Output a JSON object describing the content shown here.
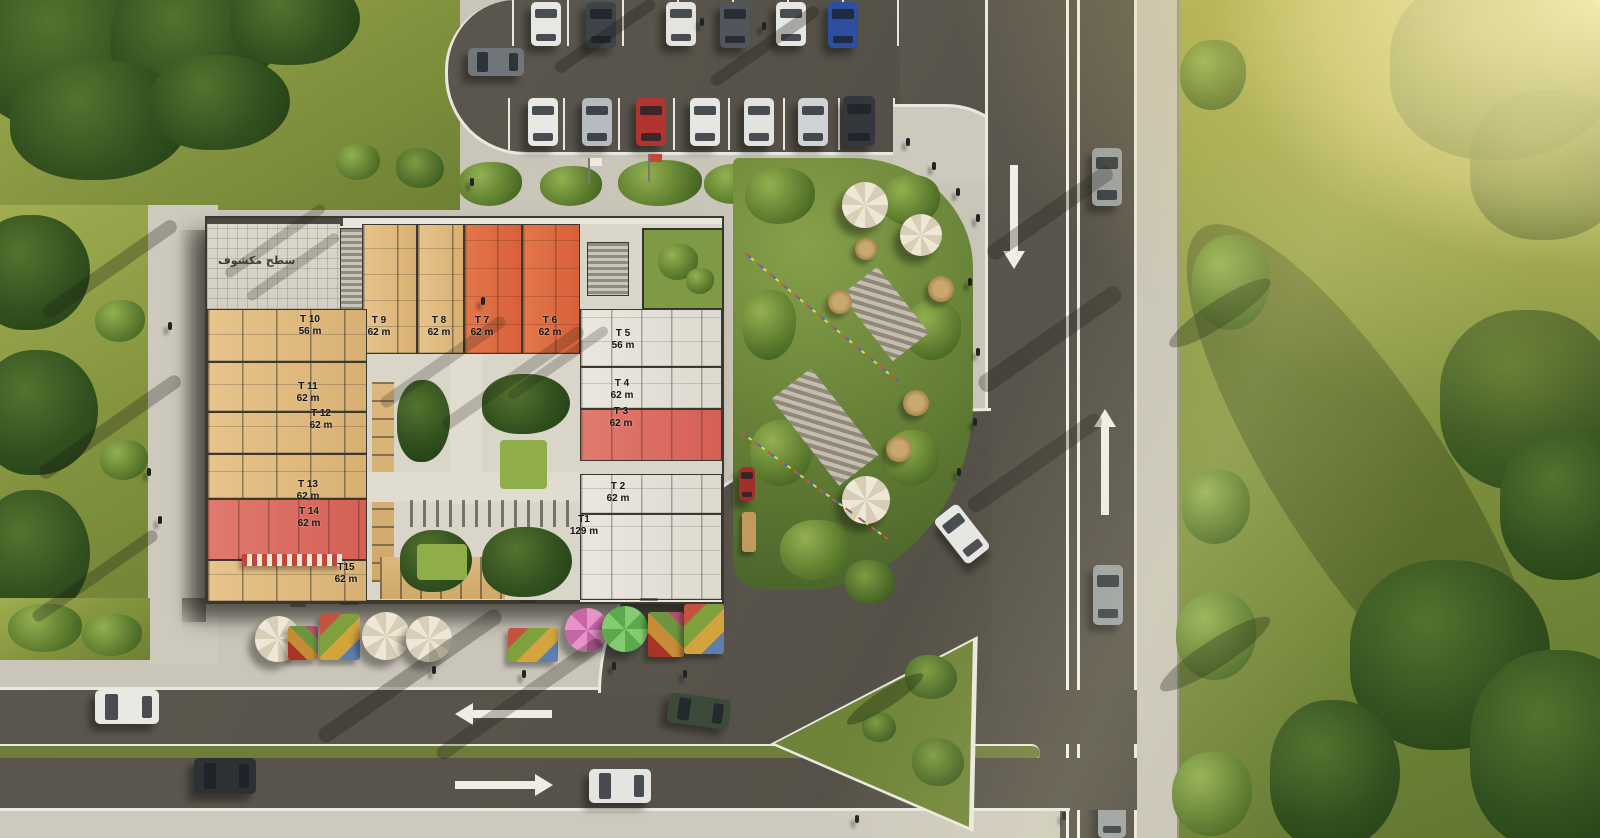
{
  "scene": {
    "type": "aerial site plan render",
    "roof_terrace_label": "سطح مكشوف",
    "units": [
      {
        "id": "T1",
        "area": "129 m",
        "fill": "white"
      },
      {
        "id": "T 2",
        "area": "62 m",
        "fill": "white"
      },
      {
        "id": "T 3",
        "area": "62 m",
        "fill": "red-highlight"
      },
      {
        "id": "T 4",
        "area": "62 m",
        "fill": "white"
      },
      {
        "id": "T 5",
        "area": "56 m",
        "fill": "white"
      },
      {
        "id": "T 6",
        "area": "62 m",
        "fill": "orange-highlight"
      },
      {
        "id": "T 7",
        "area": "62 m",
        "fill": "orange-highlight"
      },
      {
        "id": "T 8",
        "area": "62 m",
        "fill": "tan"
      },
      {
        "id": "T 9",
        "area": "62 m",
        "fill": "tan"
      },
      {
        "id": "T 10",
        "area": "56 m",
        "fill": "tan"
      },
      {
        "id": "T 11",
        "area": "62 m",
        "fill": "tan"
      },
      {
        "id": "T 12",
        "area": "62 m",
        "fill": "tan"
      },
      {
        "id": "T 13",
        "area": "62 m",
        "fill": "tan"
      },
      {
        "id": "T 14",
        "area": "62 m",
        "fill": "red-highlight"
      },
      {
        "id": "T15",
        "area": "62 m",
        "fill": "tan"
      }
    ],
    "highlight_colors": {
      "red": "#dc6a60",
      "orange": "#dd6f41",
      "tan": "#e2bd85",
      "white": "#e6e4dd",
      "asphalt": "#57534a",
      "grass": "#84933f"
    },
    "traffic_arrows": [
      {
        "id": "bottom-road-upper-lane",
        "direction": "left"
      },
      {
        "id": "bottom-road-lower-lane",
        "direction": "right"
      },
      {
        "id": "right-road-west-lane",
        "direction": "down"
      },
      {
        "id": "right-road-east-lane",
        "direction": "up"
      }
    ]
  }
}
